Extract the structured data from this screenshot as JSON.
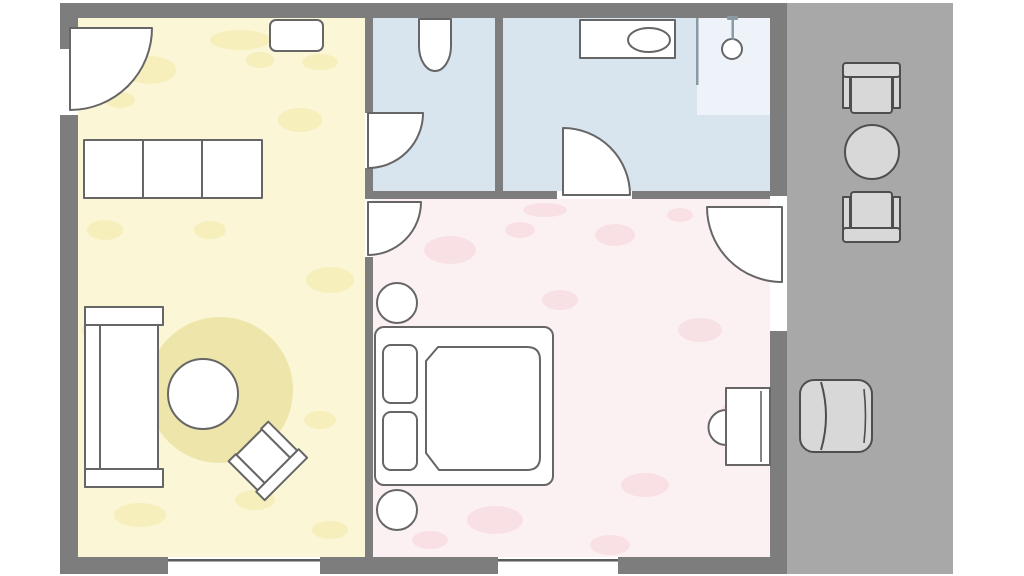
{
  "title": "apartment-floor-plan",
  "colors": {
    "background": "#ffffff",
    "wall": "#7d7d7d",
    "window_line": "#5a5a5a",
    "furniture_fill": "#ffffff",
    "furniture_outline": "#666666",
    "living_room_floor": "#faf6d6",
    "living_room_wash": "#eedd78",
    "rug": "#eee5ab",
    "wc_floor": "#d8e4ee",
    "bathroom_floor": "#d8e4ee",
    "shower_floor": "#edf3f8",
    "glass_line": "#8a99a3",
    "bedroom_floor": "#fcf1f2",
    "bedroom_wash": "#f0bcc8",
    "balcony_floor": "#a8a8a8",
    "balcony_furniture_fill": "#d8d8d8",
    "balcony_furniture_outline": "#4e4e4e"
  },
  "rooms": [
    {
      "id": "living-room",
      "color_key": "living_room_floor"
    },
    {
      "id": "wc",
      "color_key": "wc_floor"
    },
    {
      "id": "bathroom",
      "color_key": "bathroom_floor"
    },
    {
      "id": "bedroom",
      "color_key": "bedroom_floor"
    },
    {
      "id": "balcony",
      "color_key": "balcony_floor"
    }
  ],
  "furniture": [
    "entrance-door",
    "wall-cabinet",
    "sideboard",
    "sofa",
    "rug",
    "coffee-table",
    "side-chair",
    "wc-door",
    "toilet",
    "bathroom-door",
    "sink-counter",
    "washbasin",
    "shower",
    "shower-head",
    "bedroom-door",
    "double-bed",
    "pillows",
    "duvet",
    "nightstands",
    "desk",
    "desk-chair",
    "balcony-door",
    "balcony-chairs",
    "balcony-table",
    "balcony-armchair"
  ]
}
